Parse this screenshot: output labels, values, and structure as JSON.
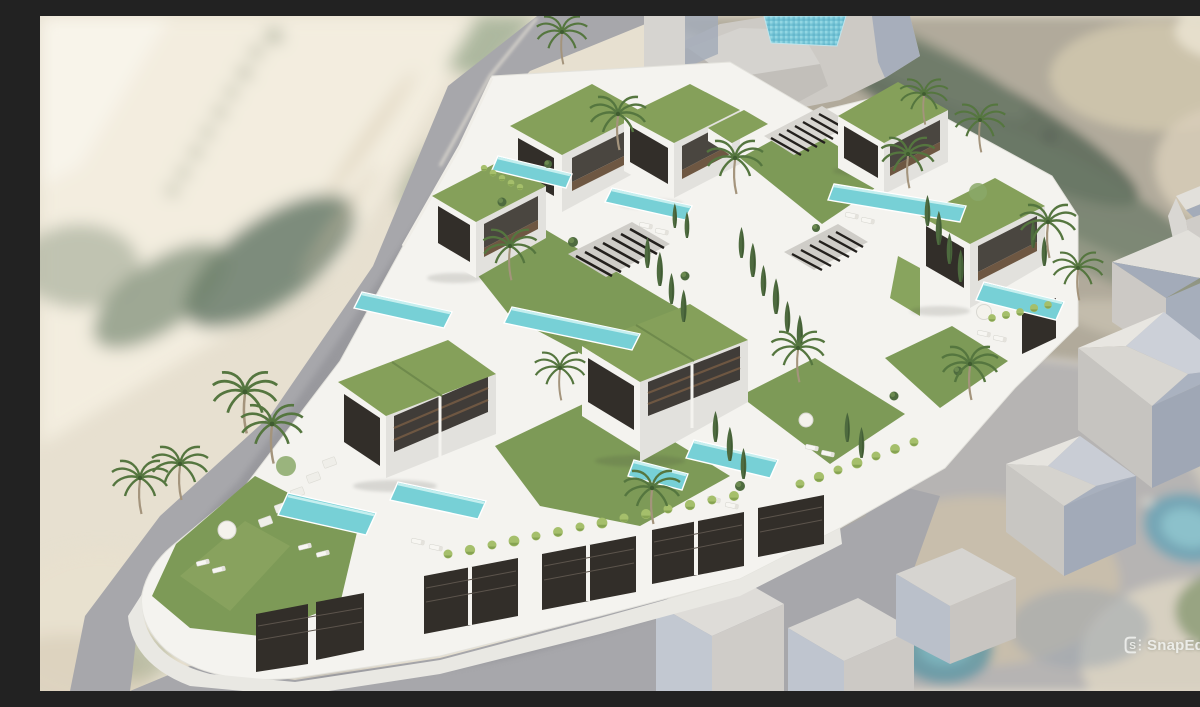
{
  "meta": {
    "type": "3d-architectural-render",
    "description": "Aerial 3D visualisation of a terraced hillside development of white modern villas with planted green roofs, private infinity pools, lawns, palm trees and cypresses, composited into a blurred satellite photo with a diagonal road on the left, grey context building massing at the top and right, and neighbouring plots below."
  },
  "watermark": {
    "label": "SnapEdit",
    "icon": "snapedit-logo-icon"
  },
  "palette": {
    "sand_beige": "#e7e0d0",
    "sand_light": "#f3eddf",
    "road_grey": "#a7a7ab",
    "road_grey_light": "#b6b4b3",
    "terrain_olive": "#b1aa9b",
    "terrain_green_dark": "#5e6c5c",
    "context_grey": "#cdcac5",
    "context_face_grey": "#b5b2ad",
    "context_shadow_blue": "#a3abb9",
    "context_light": "#e2e0db",
    "villa_white": "#f4f3ef",
    "villa_shadow": "#e2e1dd",
    "roof_grass_green": "#85a05a",
    "lawn_green": "#7d9a57",
    "hedge_green": "#a5bf6b",
    "tree_green_dark": "#4e6b3f",
    "palm_green": "#55763f",
    "trunk_brown": "#a4947c",
    "pool_teal": "#77d0d6",
    "pool_deep_teal": "#54b9c4",
    "pool_mosaic_blue": "#74c4d6",
    "dark_joinery": "#322e29",
    "wood_brown": "#6e5742",
    "shadow_grey": "#7e7e84",
    "watermark_text": "#eeefec"
  }
}
